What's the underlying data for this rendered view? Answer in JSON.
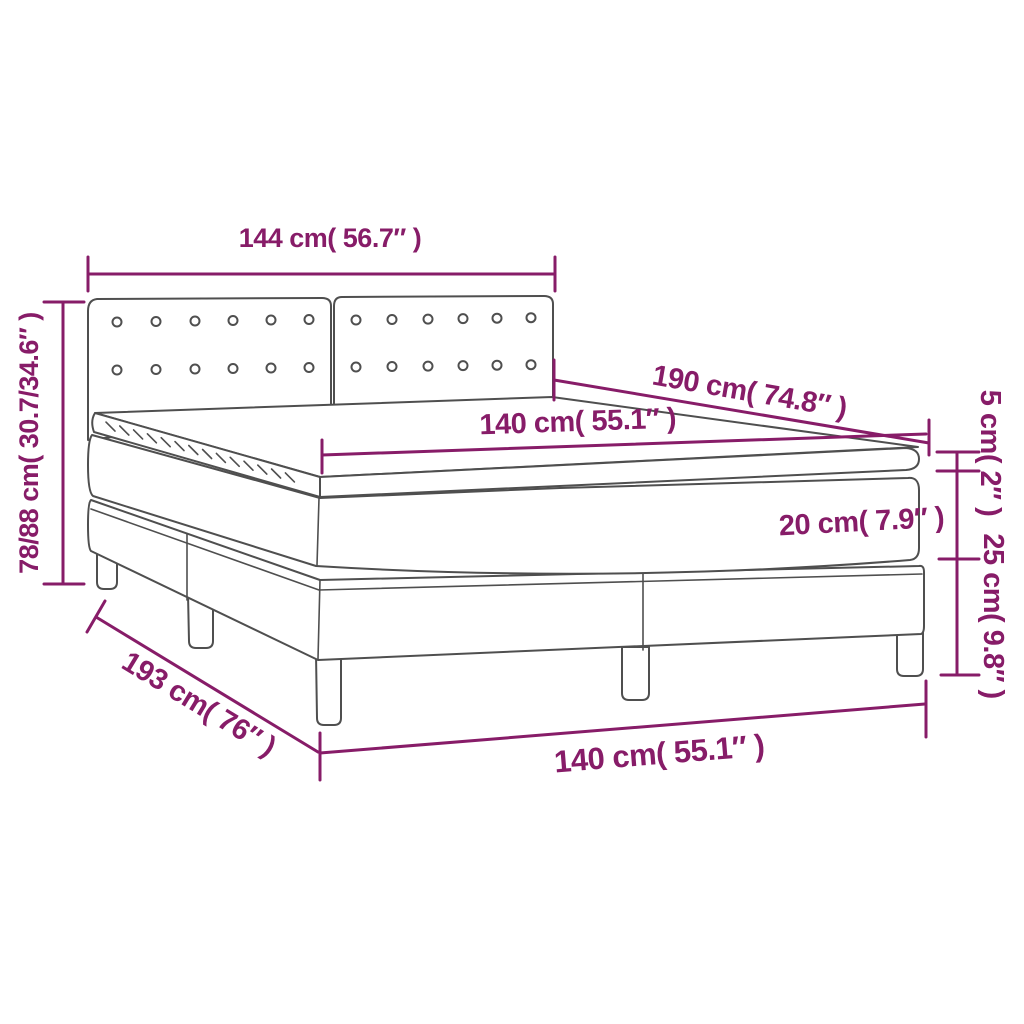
{
  "diagram": {
    "title": "box-spring-bed-dimension-diagram",
    "accent_color": "#871C68",
    "line_color": "#4F4F4F",
    "labels": {
      "headboard_width": "144 cm( 56.7″ )",
      "total_height": "78/88 cm( 30.7/34.6″ )",
      "mattress_length": "190 cm( 74.8″ )",
      "mattress_width": "140 cm( 55.1″ )",
      "topper_thickness": "5 cm( 2″ )",
      "mattress_thickness": "20 cm( 7.9″ )",
      "base_height": "25 cm( 9.8″ )",
      "bed_length": "193 cm( 76″ )",
      "bed_width": "140 cm( 55.1″ )"
    }
  }
}
